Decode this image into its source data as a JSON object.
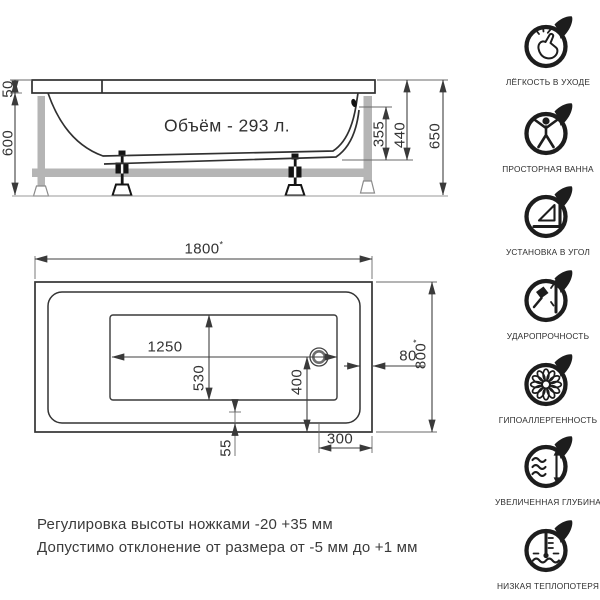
{
  "side_view": {
    "volume_label": "Объём - 293 л.",
    "dims": {
      "rim": "50",
      "height": "600",
      "inner_depth": "355",
      "shell_height": "440",
      "total_height": "650"
    }
  },
  "top_view": {
    "dims": {
      "length": {
        "value": "1800",
        "mark": "*"
      },
      "width": {
        "value": "800",
        "mark": "*"
      },
      "bottom_length": "1250",
      "bottom_width": "530",
      "drain_to_edge_y": "400",
      "rim_gap": "80",
      "drain_to_edge_x": "300",
      "corner_offset": "55"
    }
  },
  "notes": {
    "line1": "Регулировка высоты ножками -20 +35 мм",
    "line2": "Допустимо отклонение от размера от -5 мм до +1 мм"
  },
  "features": [
    {
      "icon": "easy-care-icon",
      "label": "ЛЁГКОСТЬ В УХОДЕ"
    },
    {
      "icon": "spacious-bath-icon",
      "label": "ПРОСТОРНАЯ ВАННА"
    },
    {
      "icon": "corner-install-icon",
      "label": "УСТАНОВКА В УГОЛ"
    },
    {
      "icon": "impact-resist-icon",
      "label": "УДАРОПРОЧНОСТЬ"
    },
    {
      "icon": "hypoallergenic-icon",
      "label": "ГИПОАЛЛЕРГЕННОСТЬ"
    },
    {
      "icon": "extra-depth-icon",
      "label": "УВЕЛИЧЕННАЯ ГЛУБИНА"
    },
    {
      "icon": "low-heat-loss-icon",
      "label": "НИЗКАЯ ТЕПЛОПОТЕРЯ"
    }
  ],
  "colors": {
    "line": "#303030",
    "dimension": "#3f3f3f",
    "frame_gray": "#b5b5b5",
    "icon": "#1d1d1d",
    "background": "#ffffff"
  }
}
